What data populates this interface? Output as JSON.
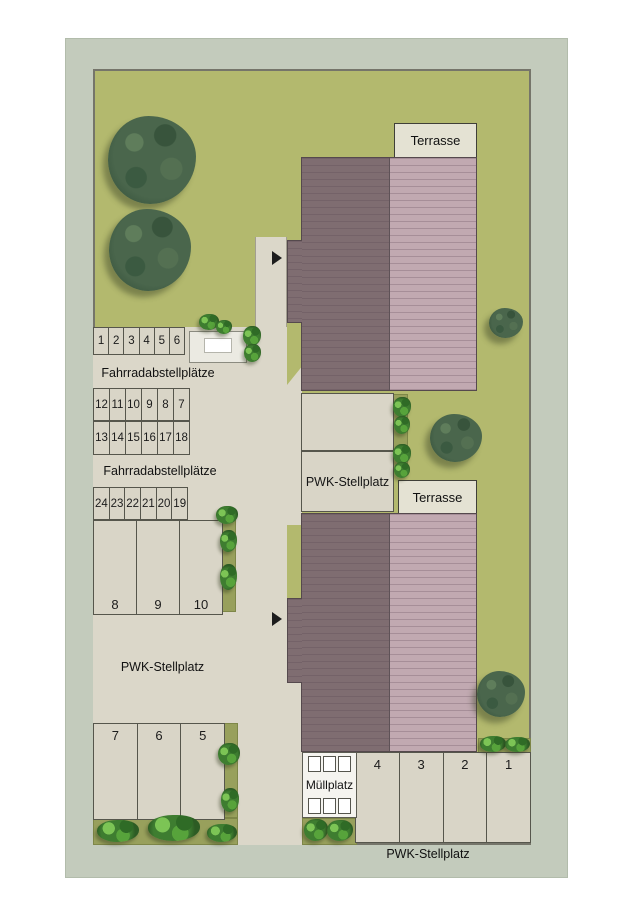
{
  "plan": {
    "title_hint": "residential site plan",
    "labels": {
      "terrasse_1": "Terrasse",
      "terrasse_2": "Terrasse",
      "fahrrad_1": "Fahrradabstellplätze",
      "fahrrad_2": "Fahrradabstellplätze",
      "pwk_mid": "PWK-Stellplatz",
      "pwk_left": "PWK-Stellplatz",
      "pwk_bottom": "PWK-Stellplatz",
      "muellplatz": "Müllplatz"
    },
    "bike_rows": {
      "top": [
        "1",
        "2",
        "3",
        "4",
        "5",
        "6"
      ],
      "row_a": [
        "12",
        "11",
        "10",
        "9",
        "8",
        "7"
      ],
      "row_b": [
        "13",
        "14",
        "15",
        "16",
        "17",
        "18"
      ],
      "row_c": [
        "24",
        "23",
        "22",
        "21",
        "20",
        "19"
      ]
    },
    "parking": {
      "mid": [
        "8",
        "9",
        "10"
      ],
      "lower_left": [
        "7",
        "6",
        "5"
      ],
      "bottom": [
        "4",
        "3",
        "2",
        "1"
      ]
    },
    "colors": {
      "lawn": "#b3b96e",
      "outer_margin": "#c3cbbc",
      "paving": "#dbd7c9",
      "roof_dark": "#7f6d71",
      "roof_light": "#c1a9b1",
      "planting_bed": "#98a05c",
      "terrace": "#e4e2d3",
      "tree": "#4a664c",
      "bush": "#3e7d30"
    }
  }
}
